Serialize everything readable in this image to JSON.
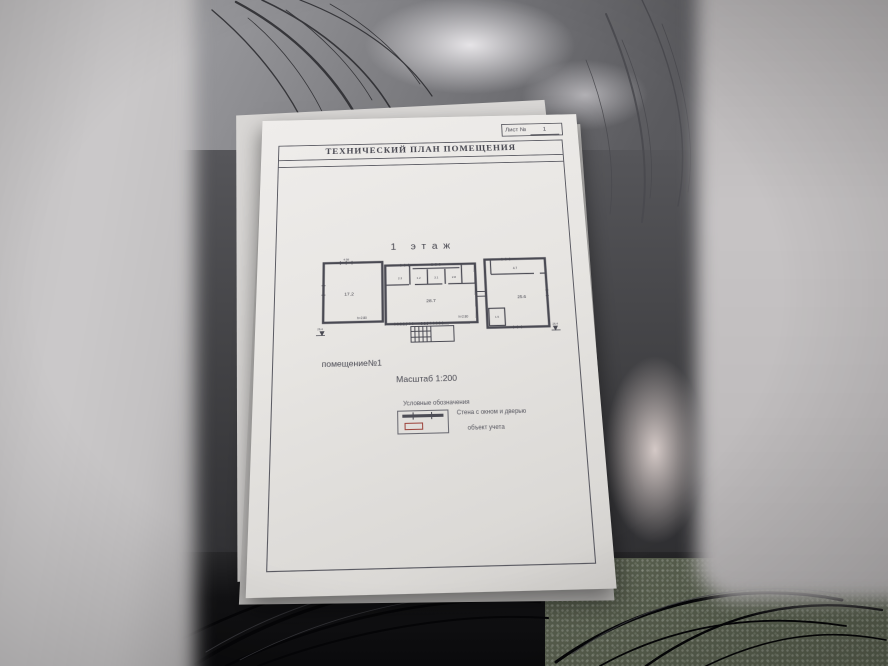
{
  "document": {
    "sheet_label": "Лист №",
    "sheet_number": "1",
    "title": "ТЕХНИЧЕСКИЙ ПЛАН ПОМЕЩЕНИЯ",
    "floor_title": "1 этаж",
    "premises_label": "помещение№1",
    "scale_label": "Масштаб 1:200",
    "legend": {
      "header": "Условные обозначения",
      "items": [
        {
          "symbol": "wall-with-window-and-door",
          "label": "Стена с окном и дверью"
        },
        {
          "symbol": "red-outline-rectangle",
          "label": "объект учета"
        }
      ],
      "object_outline_color": "#9e463e"
    },
    "plan": {
      "left_room": {
        "area": "17.2",
        "height": "h=2.80",
        "top_dim": "4.98"
      },
      "hall": {
        "area": "28.7",
        "height": "h=2.80"
      },
      "small_rooms": [
        "2.3",
        "1.2",
        "3.1",
        "2.8"
      ],
      "right_room": {
        "area": "25.6",
        "top_area": "4.7",
        "annex_area": "1.5"
      },
      "elevation_left": "26.4",
      "elevation_right": "26.4",
      "line_color": "#4a4a53"
    }
  }
}
